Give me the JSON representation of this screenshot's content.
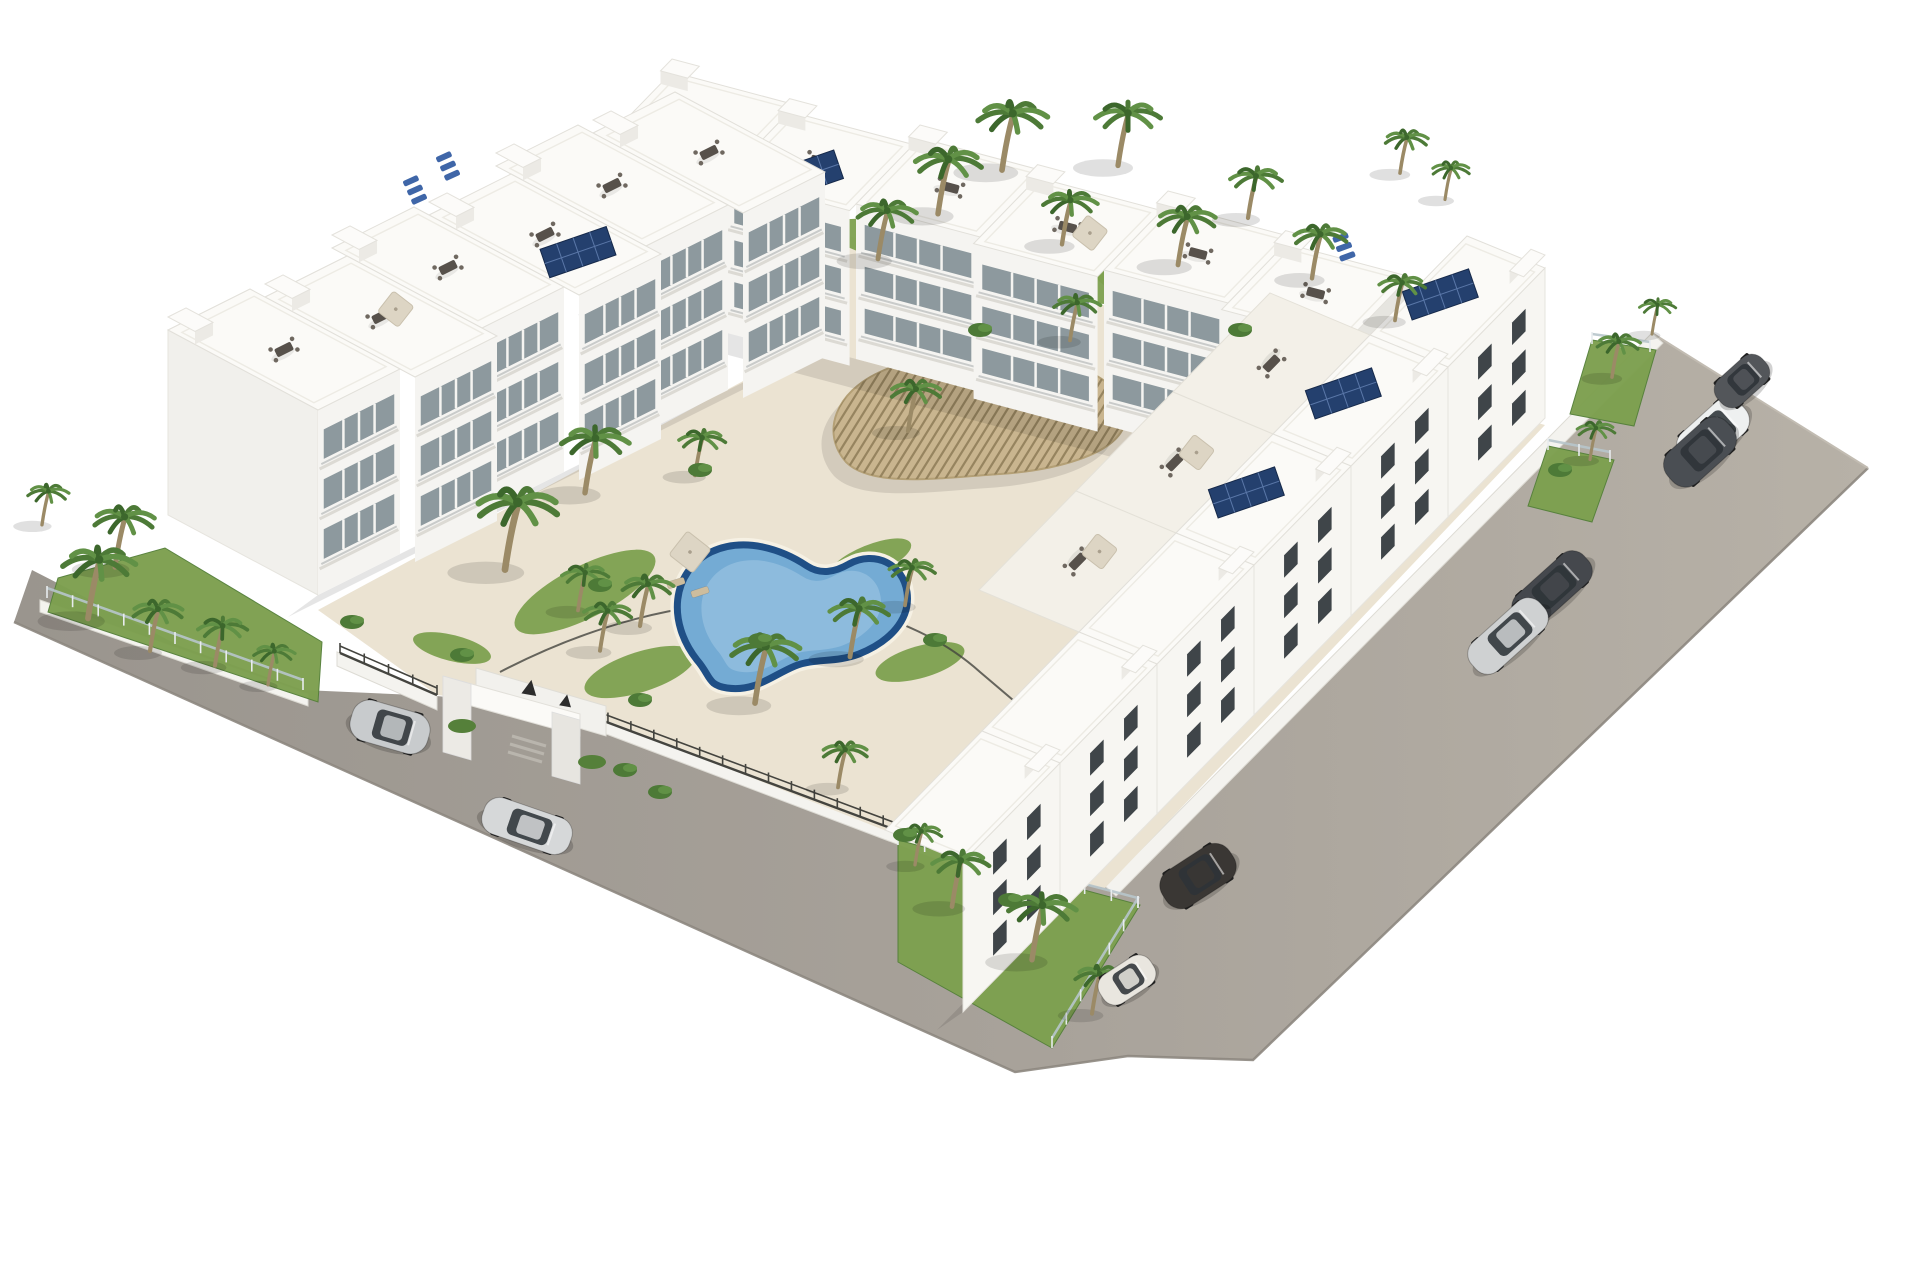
{
  "scene": {
    "description_colors": {
      "background": "#ffffff",
      "road_light": "#b7b1a7",
      "road_dark": "#9a958e",
      "road_edge": "#8d8780",
      "kerb_white": "#f4f3ef",
      "deck": "#ebe3d2",
      "lawn": "#7da04f",
      "lawn_dark": "#55803a",
      "pool_border": "#1f4f86",
      "pool_water": "#74abd4",
      "pool_light": "#a2c8e4",
      "pergola_wood": "#c9b58f",
      "pergola_slat": "#8e7c58",
      "building_white": "#fbfaf7",
      "building_face": "#f5f4f1",
      "building_shade": "#e6e5e0",
      "glass": "#8d999e",
      "window_dark": "#3f4549",
      "railing": "#c9cbca",
      "solar_panel": "#24406e",
      "solar_grid": "#5a77a8",
      "metal_fence": "#44443f",
      "glass_fence": "#b7c5cb",
      "furniture_table": "#57514b",
      "furniture_chair": "#6f6860",
      "parasol": "#ddd5c4",
      "lounger_blue": "#3f66a8",
      "lounger_gray": "#8a857c",
      "lounger_tan": "#cdbd9e",
      "palm_trunk": "#9b8a66",
      "palm_fronds": [
        "#4d7a37",
        "#619146",
        "#3c672c"
      ],
      "glyph_dark": "#2c2c2c",
      "shadow": "rgba(0,0,0,0.10)"
    },
    "road": {
      "outline": [
        [
          14,
          622
        ],
        [
          32,
          570
        ],
        [
          180,
          646
        ],
        [
          303,
          690
        ],
        [
          437,
          696
        ],
        [
          585,
          712
        ],
        [
          800,
          780
        ],
        [
          955,
          852
        ],
        [
          1105,
          886
        ],
        [
          1652,
          333
        ],
        [
          1868,
          468
        ],
        [
          1428,
          892
        ],
        [
          1253,
          1060
        ],
        [
          1128,
          1056
        ],
        [
          1015,
          1072
        ]
      ],
      "outer_edge": [
        [
          14,
          622
        ],
        [
          1015,
          1072
        ],
        [
          1128,
          1056
        ],
        [
          1253,
          1060
        ],
        [
          1428,
          892
        ],
        [
          1868,
          468
        ]
      ],
      "top_edge": [
        [
          1868,
          468
        ],
        [
          1652,
          333
        ]
      ]
    },
    "kerbs": [
      [
        [
          1105,
          886
        ],
        [
          1652,
          333
        ],
        [
          1663,
          343
        ],
        [
          1116,
          896
        ]
      ],
      [
        [
          337,
          652
        ],
        [
          437,
          696
        ],
        [
          437,
          710
        ],
        [
          337,
          666
        ]
      ],
      [
        [
          585,
          712
        ],
        [
          955,
          852
        ],
        [
          955,
          866
        ],
        [
          585,
          726
        ]
      ],
      [
        [
          40,
          600
        ],
        [
          308,
          694
        ],
        [
          308,
          706
        ],
        [
          40,
          612
        ]
      ]
    ],
    "gardens": [
      [
        [
          58,
          578
        ],
        [
          165,
          548
        ],
        [
          322,
          642
        ],
        [
          318,
          702
        ],
        [
          48,
          612
        ]
      ],
      [
        [
          898,
          840
        ],
        [
          1140,
          905
        ],
        [
          1052,
          1048
        ],
        [
          898,
          962
        ]
      ],
      [
        [
          1592,
          340
        ],
        [
          1656,
          350
        ],
        [
          1634,
          426
        ],
        [
          1570,
          414
        ]
      ],
      [
        [
          1548,
          446
        ],
        [
          1614,
          460
        ],
        [
          1592,
          522
        ],
        [
          1528,
          506
        ]
      ]
    ],
    "deck": [
      [
        318,
        610
      ],
      [
        810,
        345
      ],
      [
        845,
        235
      ],
      [
        1545,
        425
      ],
      [
        1105,
        888
      ],
      [
        950,
        856
      ],
      [
        585,
        712
      ],
      [
        437,
        695
      ]
    ],
    "lawns": [
      {
        "cx": 585,
        "cy": 592,
        "rx": 78,
        "ry": 26,
        "rot": -27
      },
      {
        "cx": 640,
        "cy": 672,
        "rx": 58,
        "ry": 20,
        "rot": -18
      },
      {
        "cx": 920,
        "cy": 662,
        "rx": 46,
        "ry": 16,
        "rot": -16
      },
      {
        "cx": 1000,
        "cy": 262,
        "rx": 180,
        "ry": 27,
        "rot": 11
      },
      {
        "cx": 1210,
        "cy": 302,
        "rx": 118,
        "ry": 22,
        "rot": 14
      },
      {
        "cx": 1430,
        "cy": 418,
        "rx": 58,
        "ry": 18,
        "rot": 16
      },
      {
        "cx": 870,
        "cy": 560,
        "rx": 44,
        "ry": 15,
        "rot": -22
      },
      {
        "cx": 452,
        "cy": 648,
        "rx": 40,
        "ry": 13,
        "rot": 14
      }
    ],
    "kidney_pool": {
      "path": "M 697 660 C 667 622 671 572 711 552 C 745 536 783 550 807 566 C 821 575 835 572 849 564 C 875 550 903 564 907 592 C 911 620 889 642 859 654 C 835 663 815 658 795 666 C 771 676 755 692 727 688 C 707 685 711 676 697 660 Z",
      "cx": 787,
      "cy": 614
    },
    "rect_pool": {
      "pts": [
        [
          1148,
          342
        ],
        [
          1243,
          309
        ],
        [
          1281,
          349
        ],
        [
          1186,
          384
        ]
      ],
      "inner": [
        [
          1158,
          344
        ],
        [
          1240,
          316
        ],
        [
          1272,
          349
        ],
        [
          1189,
          377
        ]
      ]
    },
    "pool_fence": "M 500 672 Q 600 620 700 606 Q 800 592 880 616 Q 940 636 980 672 Q 1020 706 1060 740",
    "pergola": {
      "path": "M 846 462 C 820 432 836 392 880 372 C 922 352 988 346 1046 358 C 1100 368 1134 396 1124 426 C 1114 454 1058 470 1000 474 C 940 478 872 488 846 462 Z",
      "cx": 985,
      "cy": 415,
      "slat_spacing": 8,
      "slat_dir": [
        0.53,
        -0.85
      ]
    },
    "metal_fences": [
      [
        [
          340,
          653
        ],
        [
          437,
          695
        ]
      ],
      [
        [
          585,
          714
        ],
        [
          952,
          851
        ]
      ]
    ],
    "glass_fences": [
      [
        [
          47,
          598
        ],
        [
          303,
          690
        ]
      ],
      [
        [
          898,
          845
        ],
        [
          1138,
          908
        ],
        [
          1052,
          1048
        ]
      ],
      [
        [
          1592,
          344
        ],
        [
          1650,
          352
        ]
      ],
      [
        [
          1548,
          450
        ],
        [
          1610,
          462
        ]
      ]
    ],
    "portal": {
      "back_wall": [
        [
          476,
          668
        ],
        [
          606,
          706
        ],
        [
          606,
          736
        ],
        [
          476,
          698
        ]
      ],
      "lintel": [
        [
          443,
          676
        ],
        [
          580,
          714
        ],
        [
          580,
          736
        ],
        [
          443,
          698
        ]
      ],
      "pillar_left": [
        [
          443,
          676
        ],
        [
          471,
          684
        ],
        [
          471,
          760
        ],
        [
          443,
          752
        ]
      ],
      "pillar_right": [
        [
          552,
          712
        ],
        [
          580,
          720
        ],
        [
          580,
          784
        ],
        [
          552,
          776
        ]
      ],
      "steps": [
        [
          [
            512,
            736
          ],
          [
            546,
            746
          ]
        ],
        [
          [
            510,
            744
          ],
          [
            544,
            754
          ]
        ],
        [
          [
            508,
            752
          ],
          [
            542,
            762
          ]
        ]
      ],
      "planters": [
        [
          462,
          726
        ],
        [
          592,
          762
        ]
      ],
      "glyphs": [
        {
          "x": 530,
          "y": 688,
          "s": 15
        },
        {
          "x": 566,
          "y": 701,
          "s": 12
        }
      ]
    },
    "rows": [
      {
        "name": "ne-row",
        "start": [
          672,
          72
        ],
        "unit": [
          124,
          33
        ],
        "count": 6,
        "depth": [
          -64,
          66
        ],
        "height": 155,
        "face": "balcony",
        "solar": [
          1
        ],
        "parasol": [
          3
        ],
        "sideRight": true,
        "stagger": 0.1
      },
      {
        "name": "nw-row",
        "start": [
          168,
          330
        ],
        "unit": [
          82,
          -41
        ],
        "count": 6,
        "depth": [
          150,
          80
        ],
        "height": 185,
        "face": "balcony",
        "solar": [
          3
        ],
        "parasol": [
          1
        ],
        "sideLeft": true,
        "reverse": true,
        "stagger": 0.1
      },
      {
        "name": "se-row",
        "start": [
          1545,
          268
        ],
        "unit": [
          -97,
          99
        ],
        "count": 6,
        "depth": [
          -78,
          -32
        ],
        "height": 150,
        "face": "windows",
        "solar": [
          0,
          1,
          2
        ],
        "tier": [
          -100,
          -42
        ],
        "tierUnits": [
          1,
          2,
          3
        ],
        "parasolTier": [
          2,
          3
        ]
      }
    ],
    "blue_loungers": [
      [
        448,
        166,
        -24
      ],
      [
        415,
        190,
        -24
      ],
      [
        1344,
        247,
        -20
      ]
    ],
    "pool_loungers": {
      "tan": [
        [
          676,
          583,
          -18
        ],
        [
          700,
          592,
          -18
        ]
      ],
      "gray": [
        [
          1000,
          300,
          -18
        ],
        [
          1040,
          315,
          -18
        ],
        [
          1080,
          330,
          -18
        ],
        [
          955,
          286,
          -18
        ]
      ],
      "blue": [
        [
          1158,
          399,
          -18
        ],
        [
          1185,
          410,
          -18
        ],
        [
          1212,
          421,
          -18
        ]
      ]
    },
    "parasols": [
      [
        690,
        552,
        20
      ]
    ],
    "palms": [
      [
        42,
        520,
        0.8
      ],
      [
        88,
        610,
        1.4
      ],
      [
        150,
        645,
        1.0
      ],
      [
        215,
        660,
        0.95
      ],
      [
        268,
        680,
        0.8
      ],
      [
        115,
        560,
        1.2
      ],
      [
        505,
        560,
        1.6
      ],
      [
        585,
        485,
        1.3
      ],
      [
        578,
        605,
        0.9
      ],
      [
        600,
        645,
        0.95
      ],
      [
        755,
        695,
        1.35
      ],
      [
        850,
        650,
        1.15
      ],
      [
        905,
        600,
        0.9
      ],
      [
        695,
        470,
        0.9
      ],
      [
        640,
        620,
        1.0
      ],
      [
        878,
        252,
        1.15
      ],
      [
        938,
        206,
        1.3
      ],
      [
        1002,
        162,
        1.35
      ],
      [
        1062,
        238,
        1.05
      ],
      [
        1118,
        158,
        1.25
      ],
      [
        1178,
        258,
        1.15
      ],
      [
        1248,
        212,
        1.0
      ],
      [
        1312,
        272,
        1.05
      ],
      [
        1395,
        315,
        0.9
      ],
      [
        908,
        425,
        1.0
      ],
      [
        1070,
        335,
        0.9
      ],
      [
        1400,
        168,
        0.85
      ],
      [
        1445,
        195,
        0.75
      ],
      [
        1612,
        372,
        0.85
      ],
      [
        1590,
        455,
        0.75
      ],
      [
        1652,
        330,
        0.7
      ],
      [
        952,
        900,
        1.1
      ],
      [
        1032,
        952,
        1.3
      ],
      [
        1092,
        1008,
        0.95
      ],
      [
        915,
        860,
        0.8
      ],
      [
        838,
        782,
        0.9
      ]
    ],
    "bushes": [
      [
        462,
        655
      ],
      [
        352,
        622
      ],
      [
        600,
        585
      ],
      [
        640,
        700
      ],
      [
        700,
        470
      ],
      [
        980,
        330
      ],
      [
        1240,
        330
      ],
      [
        1560,
        470
      ],
      [
        905,
        835
      ],
      [
        1010,
        900
      ],
      [
        625,
        770
      ],
      [
        660,
        792
      ],
      [
        760,
        640
      ],
      [
        935,
        640
      ]
    ],
    "cars": [
      {
        "x": 390,
        "y": 727,
        "a": 16,
        "type": "suv",
        "c": "#c8cbcd",
        "name": "silver-suv-left-road"
      },
      {
        "x": 527,
        "y": 826,
        "a": 19,
        "type": "sedan",
        "c": "#d6d8d9",
        "name": "silver-sedan-left-road"
      },
      {
        "x": 1198,
        "y": 876,
        "a": -33,
        "type": "suv",
        "c": "#3a3734",
        "name": "dark-suv-bottom-road"
      },
      {
        "x": 1127,
        "y": 980,
        "a": -33,
        "type": "mini",
        "c": "#e9e6df",
        "name": "cream-mini-bottom-road"
      },
      {
        "x": 1552,
        "y": 589,
        "a": -42,
        "type": "sedan",
        "c": "#45484d",
        "name": "dark-sedan-right-road"
      },
      {
        "x": 1508,
        "y": 636,
        "a": -42,
        "type": "sedan",
        "c": "#cfd1d2",
        "name": "silver-sedan-right-road"
      },
      {
        "x": 1713,
        "y": 433,
        "a": -42,
        "type": "suv",
        "c": "#eef0f0",
        "name": "white-suv-right-road"
      },
      {
        "x": 1700,
        "y": 452,
        "a": -42,
        "type": "suv",
        "c": "#4a4e53",
        "name": "dark-suv-right-road"
      },
      {
        "x": 1742,
        "y": 381,
        "a": -42,
        "type": "mini",
        "c": "#53565a",
        "name": "gray-hatch-right-road"
      }
    ]
  }
}
